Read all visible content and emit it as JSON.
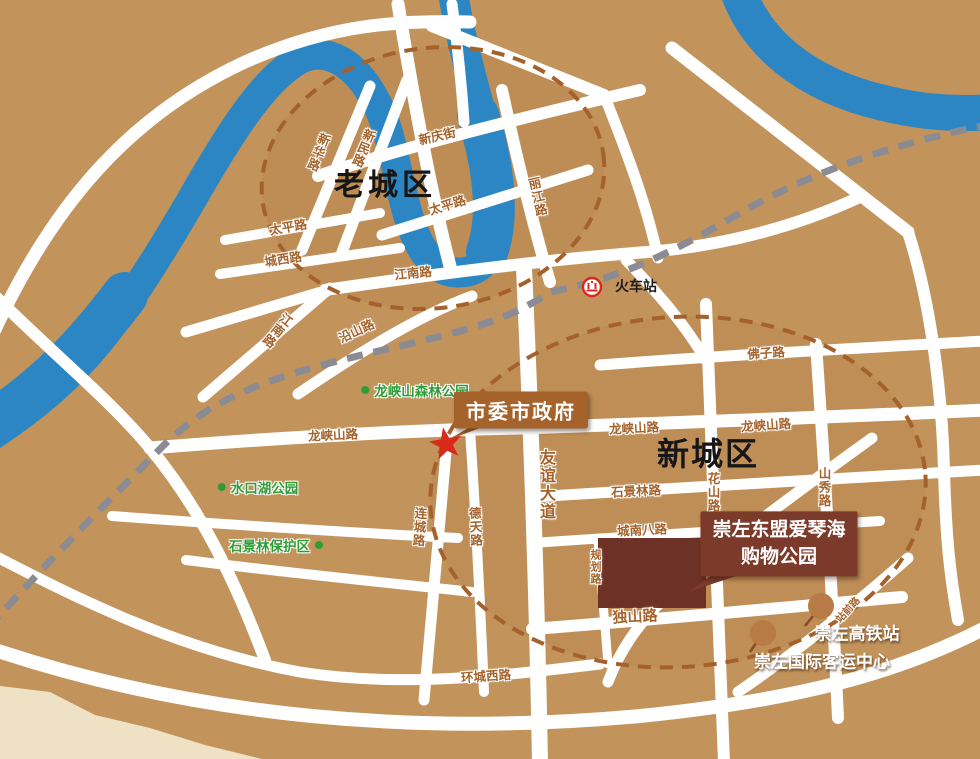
{
  "districts": {
    "old_town": "老城区",
    "new_town": "新城区"
  },
  "roads": {
    "xinhua": "新华路",
    "xinmin": "新民路",
    "xinqing": "新庆街",
    "taiping_1": "太平路",
    "taiping_2": "太平路",
    "lijiang": "丽江路",
    "chengxi": "城西路",
    "jiangnan_1": "江南路",
    "jiangnan_2": "江南路",
    "yanshan": "沿山路",
    "longxiashan_1": "龙峡山路",
    "longxiashan_2": "龙峡山路",
    "longxiashan_3": "龙峡山路",
    "fozi": "佛子路",
    "youyi": "友谊大道",
    "shijinglin": "石景林路",
    "huashan": "花山路",
    "shanxiu": "山秀路",
    "liancheng": "连城路",
    "detian": "德天路",
    "chengnanba": "城南八路",
    "guihua": "规划路",
    "dushan": "独山路",
    "huanchengxi": "环城西路",
    "zhanqian": "站前路"
  },
  "parks": {
    "longxiashan_forest": "龙峡山森林公园",
    "shuikouhu": "水口湖公园",
    "shijinglin_reserve": "石景林保护区"
  },
  "pois": {
    "railway_station": "火车站",
    "government": "市委市政府",
    "shopping_line1": "崇左东盟爱琴海",
    "shopping_line2": "购物公园",
    "hsr_station": "崇左高铁站",
    "passenger_center": "崇左国际客运中心"
  },
  "colors": {
    "land": "#C2935B",
    "river": "#2C86C4",
    "road": "#FFFFFF",
    "railway": "#8B8B93",
    "boundary_dash": "#A5612C",
    "road_label": "#A5622B",
    "park_green": "#2F9C35",
    "badge_brown": "#A5622B",
    "badge_dark": "#7B3A2A",
    "building_block": "#6E3126",
    "star_red": "#D8291B",
    "marker_dot": "#B97B45",
    "lowland_cream": "#EFE2C4",
    "district_text": "#161616"
  }
}
